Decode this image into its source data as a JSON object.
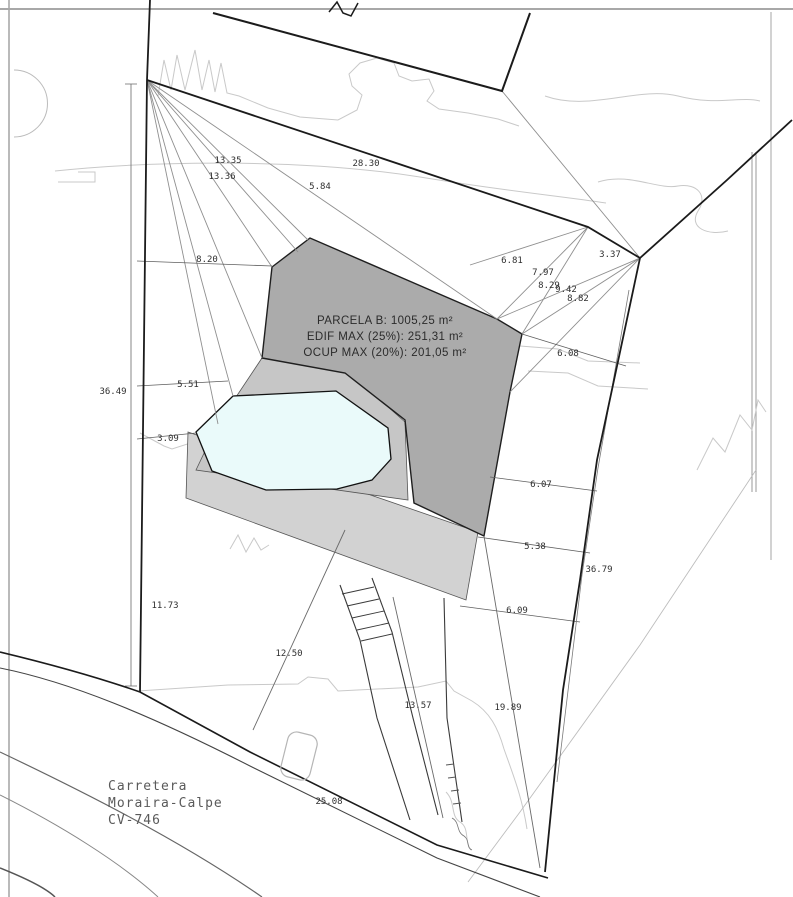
{
  "drawing": {
    "parcel_text": {
      "line1": "PARCELA B: 1005,25 m²",
      "line2": "EDIF MAX (25%): 251,31 m²",
      "line3": "OCUP MAX (20%): 201,05 m²"
    },
    "road_text": {
      "line1": "Carretera",
      "line2": "Moraira-Calpe",
      "line3": "CV-746"
    },
    "dimensions": [
      {
        "text": "13.35"
      },
      {
        "text": "13.36"
      },
      {
        "text": "28.30"
      },
      {
        "text": "5.84"
      },
      {
        "text": "8.20"
      },
      {
        "text": "6.81"
      },
      {
        "text": "7.97"
      },
      {
        "text": "8.29"
      },
      {
        "text": "9.42"
      },
      {
        "text": "8.82"
      },
      {
        "text": "3.37"
      },
      {
        "text": "6.08"
      },
      {
        "text": "36.49"
      },
      {
        "text": "5.51"
      },
      {
        "text": "3.09"
      },
      {
        "text": "6.07"
      },
      {
        "text": "5.38"
      },
      {
        "text": "36.79"
      },
      {
        "text": "11.73"
      },
      {
        "text": "6.09"
      },
      {
        "text": "12.50"
      },
      {
        "text": "13.57"
      },
      {
        "text": "19.89"
      },
      {
        "text": "25.08"
      }
    ],
    "colors": {
      "boundary": "#1b1b1b",
      "building_envelope_dark": "#ababab",
      "terrace_medium": "#c6c6c6",
      "band_light": "#d2d2d2",
      "pool": "#eafafa",
      "contour": "#c9c9c9"
    }
  }
}
